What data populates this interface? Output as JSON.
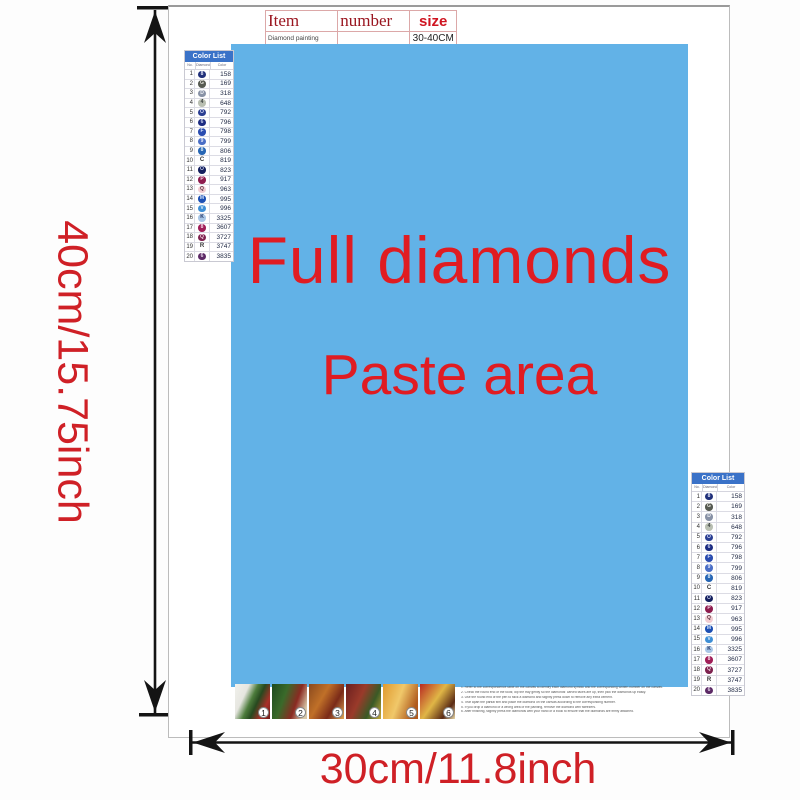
{
  "colors": {
    "paste_bg": "#62b2e7",
    "accent_red": "#e01c22",
    "dim_red": "#cf2026",
    "table_header_blue": "#3a72c8"
  },
  "item_table": {
    "col_item": "Item",
    "col_number": "number",
    "col_size": "size",
    "row_item": "Diamond painting",
    "row_number": "",
    "row_size": "30-40CM"
  },
  "paste_area": {
    "line1": "Full diamonds",
    "line2": "Paste area"
  },
  "dimensions": {
    "height": "40cm/15.75inch",
    "width": "30cm/11.8inch"
  },
  "color_list": {
    "title": "Color List",
    "col_no": "No.",
    "col_symbol": "Diamond",
    "col_color": "Color",
    "rows": [
      {
        "no": "1",
        "symbol": "8",
        "code": "158",
        "circle": "#20307a",
        "fg": "#dfe4f6",
        "plain": false
      },
      {
        "no": "2",
        "symbol": "G",
        "code": "169",
        "circle": "#575b52",
        "fg": "#e2e2da",
        "plain": false
      },
      {
        "no": "3",
        "symbol": "D",
        "code": "318",
        "circle": "#8892a6",
        "fg": "#f0f2f6",
        "plain": false
      },
      {
        "no": "4",
        "symbol": "4",
        "code": "648",
        "circle": "#b9bfb2",
        "fg": "#3c4240",
        "plain": false
      },
      {
        "no": "5",
        "symbol": "O",
        "code": "792",
        "circle": "#2a3e92",
        "fg": "#d4daf2",
        "plain": false
      },
      {
        "no": "6",
        "symbol": "6",
        "code": "796",
        "circle": "#1c2c82",
        "fg": "#ccd4ee",
        "plain": false
      },
      {
        "no": "7",
        "symbol": "F",
        "code": "798",
        "circle": "#2a4cb0",
        "fg": "#d6e0f6",
        "plain": false
      },
      {
        "no": "8",
        "symbol": "9",
        "code": "799",
        "circle": "#4a6ec6",
        "fg": "#e4eafa",
        "plain": false
      },
      {
        "no": "9",
        "symbol": "8",
        "code": "806",
        "circle": "#2766b4",
        "fg": "#d8eaf6",
        "plain": false
      },
      {
        "no": "10",
        "symbol": "C",
        "code": "819",
        "circle": "#f8f0f0",
        "fg": "#333333",
        "plain": true
      },
      {
        "no": "11",
        "symbol": "O",
        "code": "823",
        "circle": "#141f5e",
        "fg": "#c8d0ea",
        "plain": false
      },
      {
        "no": "12",
        "symbol": "P",
        "code": "917",
        "circle": "#8e1c4e",
        "fg": "#f4d6e4",
        "plain": false
      },
      {
        "no": "13",
        "symbol": "Q",
        "code": "963",
        "circle": "#f2cdd2",
        "fg": "#5a3040",
        "plain": false
      },
      {
        "no": "14",
        "symbol": "M",
        "code": "995",
        "circle": "#1d50b4",
        "fg": "#d4e2f8",
        "plain": false
      },
      {
        "no": "15",
        "symbol": "V",
        "code": "996",
        "circle": "#3f8fd6",
        "fg": "#e4f0fa",
        "plain": false
      },
      {
        "no": "16",
        "symbol": "K",
        "code": "3325",
        "circle": "#a9c6e6",
        "fg": "#1c2c5e",
        "plain": false
      },
      {
        "no": "17",
        "symbol": "8",
        "code": "3607",
        "circle": "#a01e58",
        "fg": "#f6d8e6",
        "plain": false
      },
      {
        "no": "18",
        "symbol": "Q",
        "code": "3727",
        "circle": "#7e2350",
        "fg": "#f0d4e0",
        "plain": false
      },
      {
        "no": "19",
        "symbol": "R",
        "code": "3747",
        "circle": "#f4f2fa",
        "fg": "#333333",
        "plain": true
      },
      {
        "no": "20",
        "symbol": "6",
        "code": "3835",
        "circle": "#5c2a66",
        "fg": "#e6d8ea",
        "plain": false
      }
    ]
  },
  "steps": [
    "1",
    "2",
    "3",
    "4",
    "5",
    "6"
  ],
  "instructions": [
    "1. Refer to the correspondence table on the canvas to identify each diamond symbol and the corresponding written number on the canvas.",
    "2. Check the round end of the tools; dip the tray gently so the diamonds' carved faces are up, then pick the diamonds up easily.",
    "3. Use the round end of the pen to stick a diamond and slightly press down to remove any extra cement.",
    "4. Tear apart the partial film and place the diamond on the canvas according to the corresponding number.",
    "5. If you drop a diamond or a wrong area of the painting, remove the diamond with tweezers.",
    "6. After finishing, slightly press the diamonds with your hand or a book to ensure that the diamonds are firmly attached."
  ]
}
